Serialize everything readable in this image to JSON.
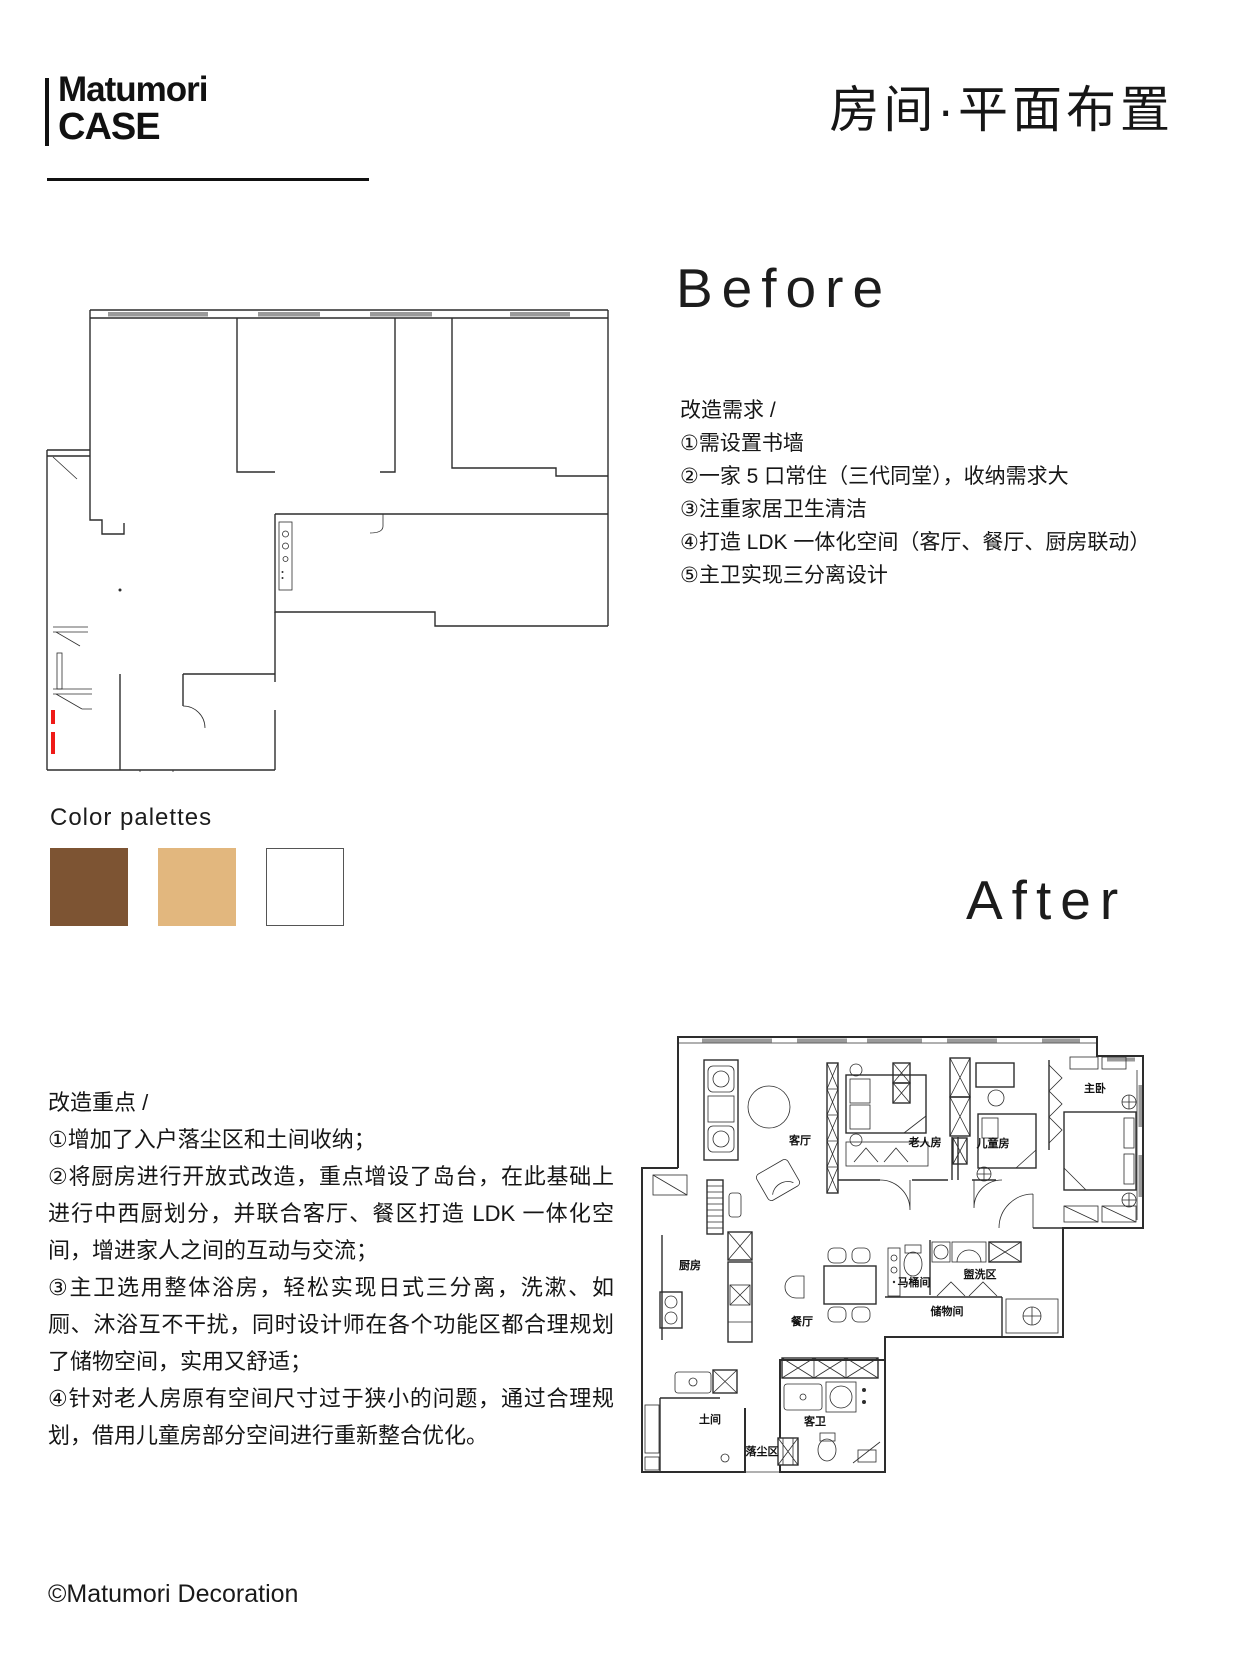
{
  "page": {
    "logo_line1": "Matumori",
    "logo_line2": "CASE",
    "title": "房间·平面布置",
    "copyright": "©Matumori Decoration"
  },
  "before": {
    "heading": "Before",
    "requirements": "改造需求 /\n①需设置书墙\n②一家 5 口常住（三代同堂），收纳需求大\n③注重家居卫生清洁\n④打造 LDK 一体化空间（客厅、餐厅、厨房联动）\n⑤主卫实现三分离设计"
  },
  "palette": {
    "label": "Color palettes",
    "colors": [
      "#7d5433",
      "#e2b77e",
      "#ffffff"
    ]
  },
  "after": {
    "heading": "After",
    "highlights": "改造重点 /\n①增加了入户落尘区和土间收纳；\n②将厨房进行开放式改造，重点增设了岛台，在此基础上进行中西厨划分，并联合客厅、餐区打造 LDK 一体化空间，增进家人之间的互动与交流；\n③主卫选用整体浴房，轻松实现日式三分离，洗漱、如厕、沐浴互不干扰，同时设计师在各个功能区都合理规划了储物空间，实用又舒适；\n④针对老人房原有空间尺寸过于狭小的问题，通过合理规划，借用儿童房部分空间进行重新整合优化。",
    "rooms": {
      "living": "客厅",
      "elder": "老人房",
      "kids": "儿童房",
      "master": "主卧",
      "kitchen": "厨房",
      "dining": "餐厅",
      "toilet": "马桶间",
      "wash": "盥洗区",
      "storage": "储物间",
      "mud": "土间",
      "dust": "落尘区",
      "guest_bath": "客卫"
    }
  }
}
